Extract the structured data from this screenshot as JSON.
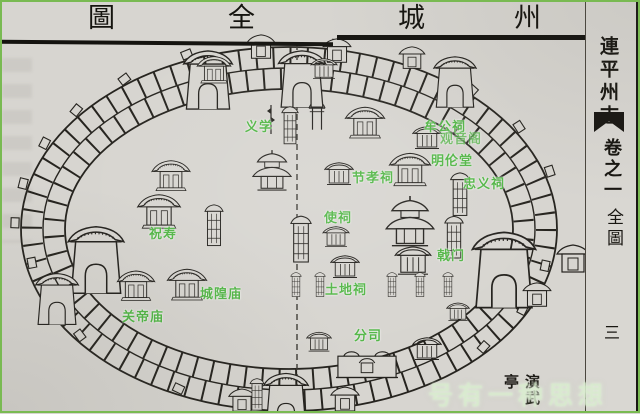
{
  "header": {
    "title_chars": [
      "圖",
      "全",
      "城",
      "州"
    ]
  },
  "margin": {
    "book_title": "連平州志",
    "volume_label": "卷之一",
    "section_label": "全圖",
    "page_number": "三"
  },
  "map": {
    "labels": [
      {
        "text": "义学"
      },
      {
        "text": "牟公祠"
      },
      {
        "text": "观音阁"
      },
      {
        "text": "明伦堂"
      },
      {
        "text": "忠义祠"
      },
      {
        "text": "节孝祠"
      },
      {
        "text": "使祠"
      },
      {
        "text": "祝寿"
      },
      {
        "text": "戟门"
      },
      {
        "text": "城隍庙"
      },
      {
        "text": "关帝庙"
      },
      {
        "text": "土地祠"
      },
      {
        "text": "分司"
      }
    ],
    "printed_label": "演武亭"
  },
  "watermark": {
    "text": "号有一种思想"
  },
  "colors": {
    "paper": "#d7d5d0",
    "ink": "#24221e",
    "label_green": "#53b647",
    "border_green": "#79ba52"
  }
}
